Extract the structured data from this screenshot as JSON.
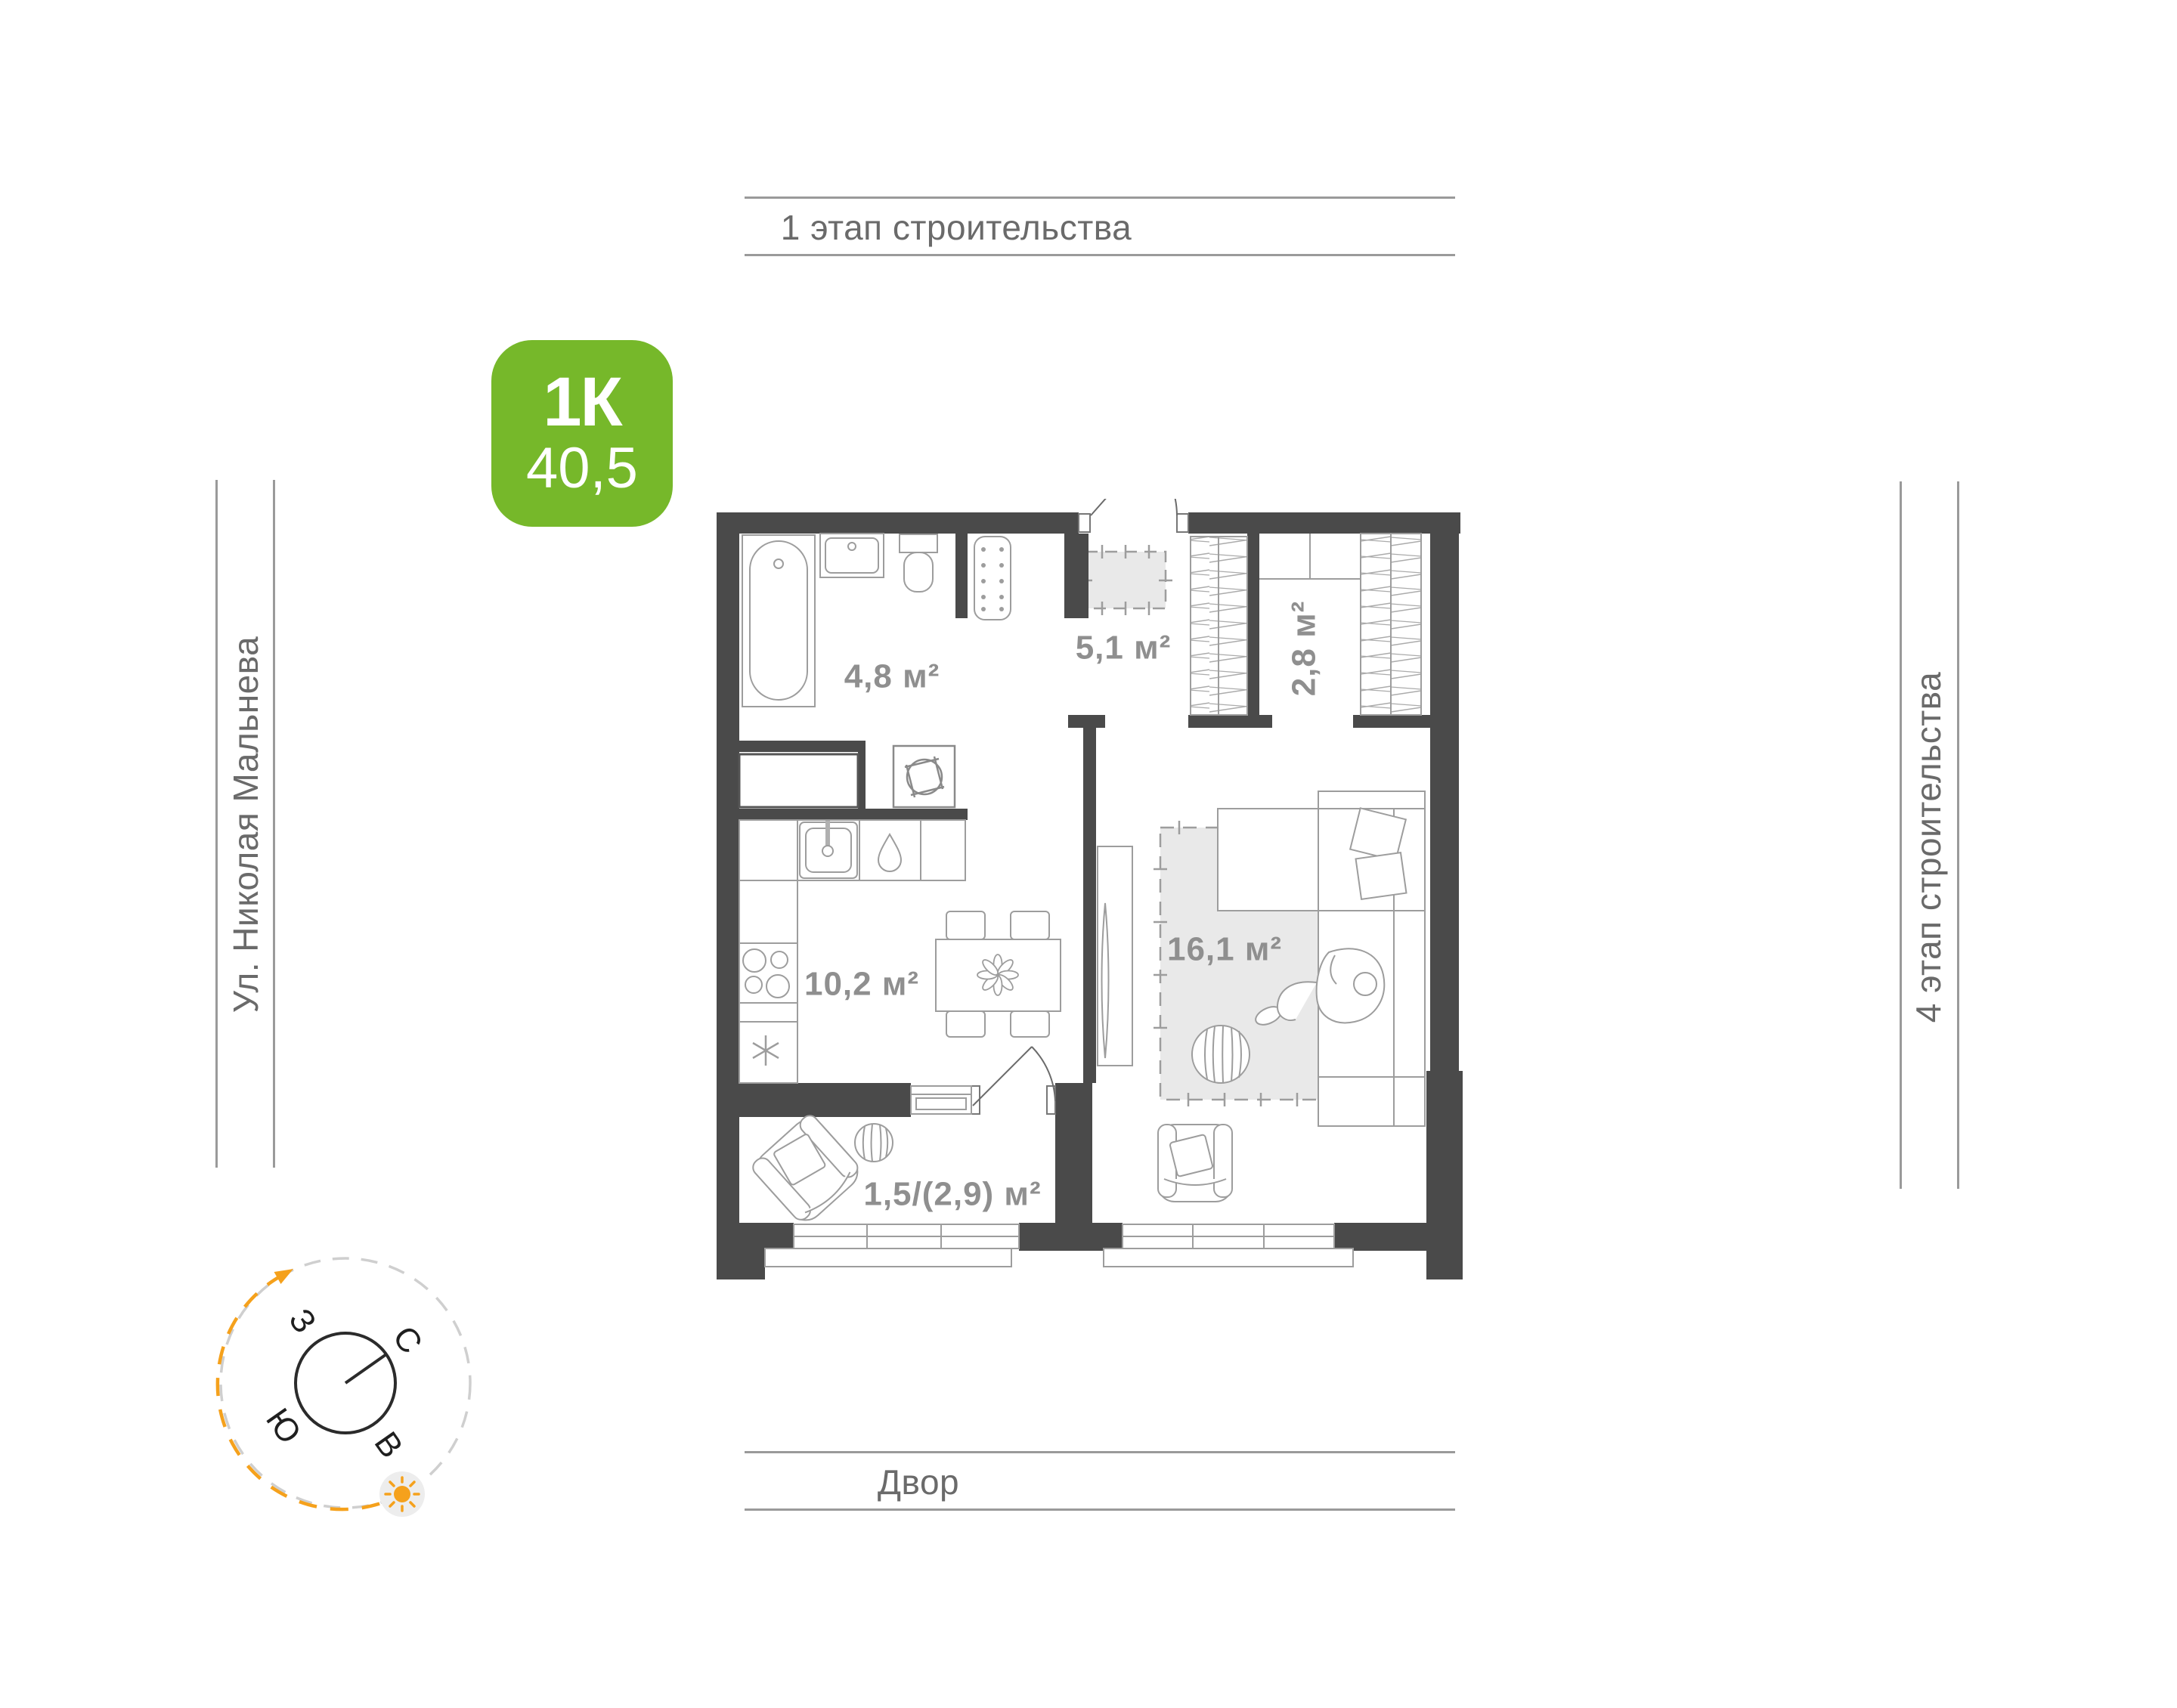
{
  "surroundings": {
    "top_label": "1 этап строительства",
    "left_label": "Ул. Николая Мальнева",
    "right_label": "4 этап строительства",
    "bottom_label": "Двор"
  },
  "apartment_badge": {
    "rooms_label": "1К",
    "area_value": "40,5"
  },
  "room_areas": {
    "bathroom": "4,8 м²",
    "hallway": "5,1 м²",
    "closet": "2,8 м²",
    "kitchen": "10,2 м²",
    "living_room": "16,1 м²",
    "balcony": "1,5/(2,9) м²"
  },
  "compass": {
    "north": "С",
    "east": "В",
    "south": "Ю",
    "west": "З"
  },
  "colors": {
    "badge_green": "#76b82a",
    "compass_orange": "#f5a11c",
    "wall_dark": "#4a4a4a",
    "guide_line_gray": "#9a9a9a",
    "guide_text_gray": "#6a6a6a",
    "area_text_gray": "#8f8f8f",
    "furniture_stroke": "#9d9d9d",
    "rug_fill": "#e9e9e9"
  }
}
